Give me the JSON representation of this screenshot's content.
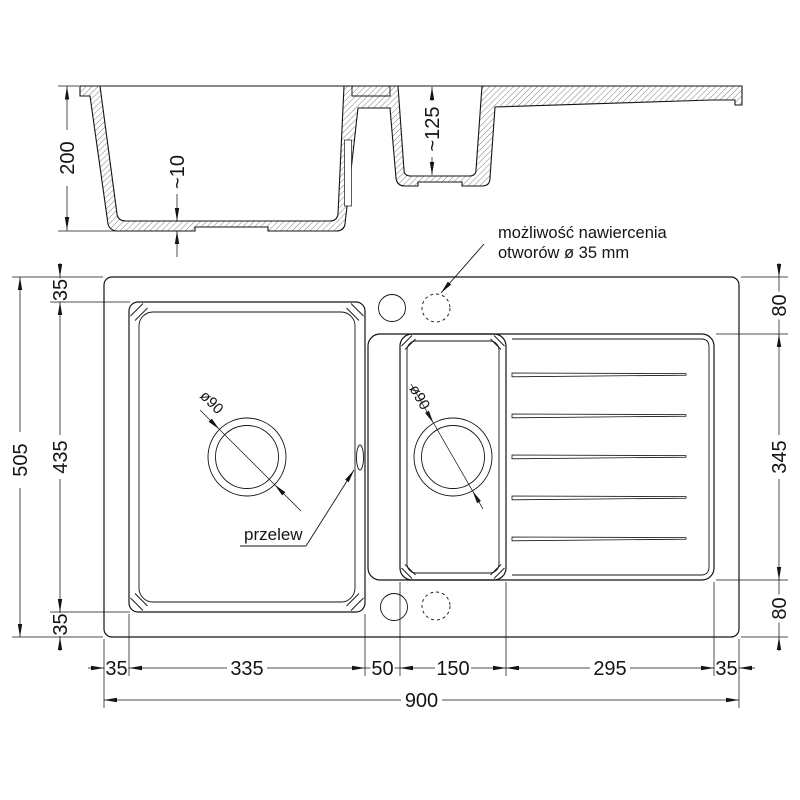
{
  "drawing": {
    "subject": "kitchen sink technical drawing, 1.5 bowls with drainer",
    "section_view": {
      "depth_overall": "200",
      "floor_thickness": "~10",
      "depth_small_bowl": "~125"
    },
    "plan_view": {
      "overall_width": "900",
      "overall_depth": "505",
      "left_dims": {
        "top": "35",
        "middle": "435",
        "bottom": "35"
      },
      "right_dims": {
        "top": "80",
        "middle": "345",
        "bottom": "80"
      },
      "bottom_dims": {
        "d1": "35",
        "d2": "335",
        "d3": "50",
        "d4": "150",
        "d5": "295",
        "d6": "35"
      },
      "drain_main": "ø90",
      "drain_small": "ø90",
      "overflow": "przelew",
      "note": {
        "line1": "możliwość nawiercenia",
        "line2": "otworów ø 35 mm"
      }
    }
  }
}
